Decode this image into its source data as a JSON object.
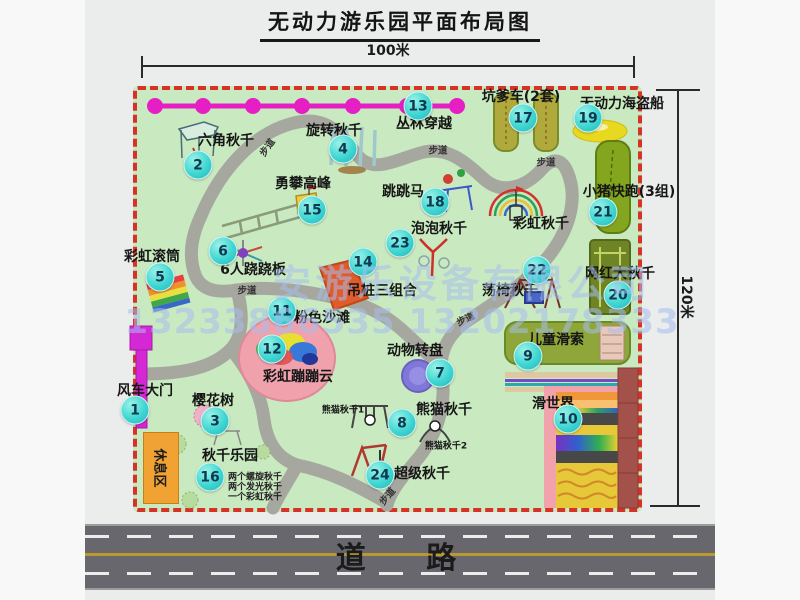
{
  "title": "无动力游乐园平面布局图",
  "dimensions": {
    "width": "100米",
    "height": "120米"
  },
  "road": {
    "label": "道 路"
  },
  "watermark": {
    "company": "安游乐设备有限公司",
    "phone": "13233866535 13202178333"
  },
  "walkway_label": "步道",
  "rest_area": {
    "label": "休息区"
  },
  "extra_labels": {
    "rainbow_swing": "彩虹秋千",
    "panda_swing_1": "熊猫秋千1",
    "panda_swing_2": "熊猫秋千2"
  },
  "swing_park_notes": [
    "两个螺旋秋千",
    "两个发光秋千",
    "一个彩虹秋千"
  ],
  "attractions": [
    {
      "num": "1",
      "label": "风车大门"
    },
    {
      "num": "2",
      "label": "六角秋千"
    },
    {
      "num": "3",
      "label": "樱花树"
    },
    {
      "num": "4",
      "label": "旋转秋千"
    },
    {
      "num": "5",
      "label": "彩虹滚筒"
    },
    {
      "num": "6",
      "label": "6人跷跷板"
    },
    {
      "num": "7",
      "label": "动物转盘"
    },
    {
      "num": "8",
      "label": "熊猫秋千"
    },
    {
      "num": "9",
      "label": "儿童滑索"
    },
    {
      "num": "10",
      "label": "滑世界"
    },
    {
      "num": "11",
      "label": "粉色沙滩"
    },
    {
      "num": "12",
      "label": "彩虹蹦蹦云"
    },
    {
      "num": "13",
      "label": "丛林穿越"
    },
    {
      "num": "14",
      "label": "吊桩三组合"
    },
    {
      "num": "15",
      "label": "勇攀高峰"
    },
    {
      "num": "16",
      "label": "秋千乐园"
    },
    {
      "num": "17",
      "label": "坑爹车(2套)"
    },
    {
      "num": "18",
      "label": "跳跳马"
    },
    {
      "num": "19",
      "label": "无动力海盗船"
    },
    {
      "num": "20",
      "label": "网红大秋千"
    },
    {
      "num": "21",
      "label": "小猪快跑(3组)"
    },
    {
      "num": "22",
      "label": "荡椅秋千"
    },
    {
      "num": "23",
      "label": "泡泡秋千"
    },
    {
      "num": "24",
      "label": "超级秋千"
    }
  ],
  "colors": {
    "map_bg": "#c9e9c0",
    "map_border": "#d63226",
    "bubble": "#3fd6d2",
    "garland": "#e51fc4",
    "gate": "#d428d4",
    "road": "#67676d",
    "beach": "#f0a2ac"
  }
}
